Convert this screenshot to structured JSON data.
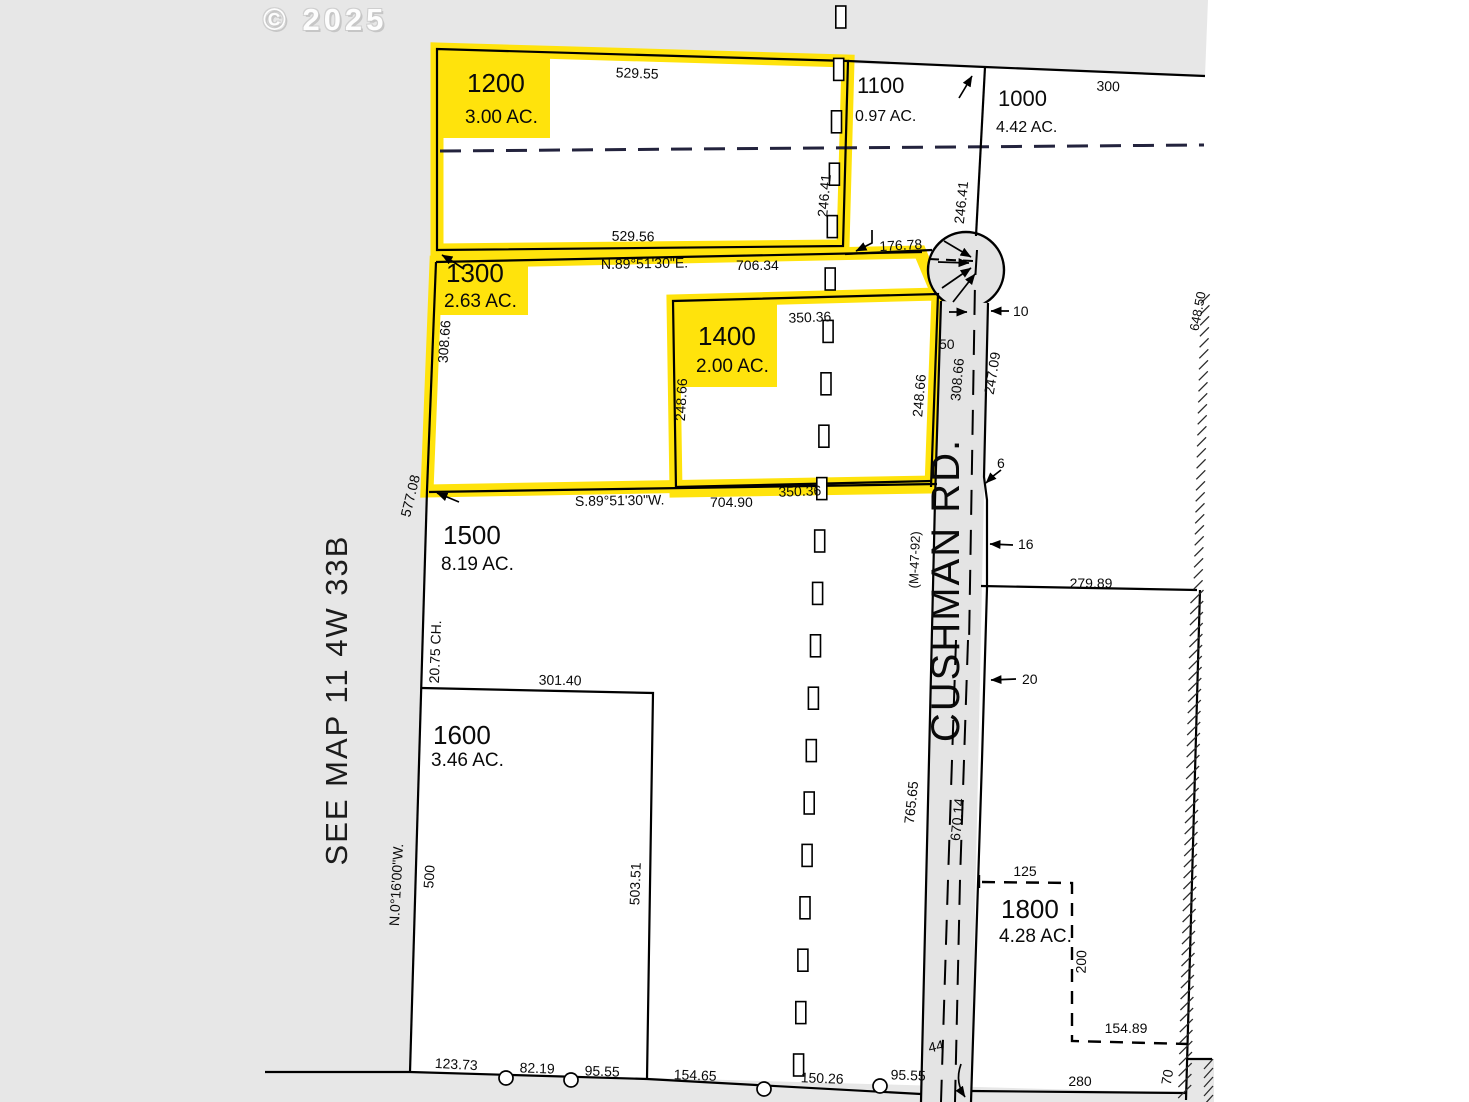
{
  "watermark": "© 2025",
  "side_label": "SEE MAP  11 4W 33B",
  "road": {
    "name": "CUSHMAN  RD.",
    "ref": "(M-47-92)"
  },
  "lots": [
    {
      "id": "1200",
      "ac": "3.00 AC."
    },
    {
      "id": "1100",
      "ac": "0.97 AC."
    },
    {
      "id": "1000",
      "ac": "4.42 AC."
    },
    {
      "id": "1300",
      "ac": "2.63 AC."
    },
    {
      "id": "1400",
      "ac": "2.00 AC."
    },
    {
      "id": "1500",
      "ac": "8.19 AC."
    },
    {
      "id": "1600",
      "ac": "3.46 AC."
    },
    {
      "id": "1800",
      "ac": "4.28 AC."
    }
  ],
  "bearings": {
    "north_line": "N.89°51'30\"E.",
    "north_line_len": "706.34",
    "south_line": "S.89°51'30\"W.",
    "south_line_len": "704.90",
    "west_line": "N.0°16'00\"W."
  },
  "dims": {
    "d529_55": "529.55",
    "d529_56": "529.56",
    "d246_41_w": "246.41",
    "d246_41_e": "246.41",
    "d300": "300",
    "d176_78": "176.78",
    "d350_36_n": "350.36",
    "d350_36_s": "350.36",
    "d248_66_w": "248.66",
    "d248_66_e": "248.66",
    "d308_66_w": "308.66",
    "d308_66_e": "308.66",
    "d247_09": "247.09",
    "d577_08": "577.08",
    "d20_75": "20.75 CH.",
    "d301_40": "301.40",
    "d500": "500",
    "d503_51": "503.51",
    "d123_73": "123.73",
    "d82_19": "82.19",
    "d95_55_a": "95.55",
    "d154_65": "154.65",
    "d150_26": "150.26",
    "d95_55_b": "95.55",
    "d44": "44",
    "d280": "280",
    "d70": "70",
    "d125": "125",
    "d200": "200",
    "d154_89": "154.89",
    "d279_89": "279.89",
    "d765_65": "765.65",
    "d670_14": "670.14",
    "d648_50": "648.50",
    "d50": "50",
    "d10": "10",
    "d6": "6",
    "d16": "16",
    "d20": "20"
  }
}
